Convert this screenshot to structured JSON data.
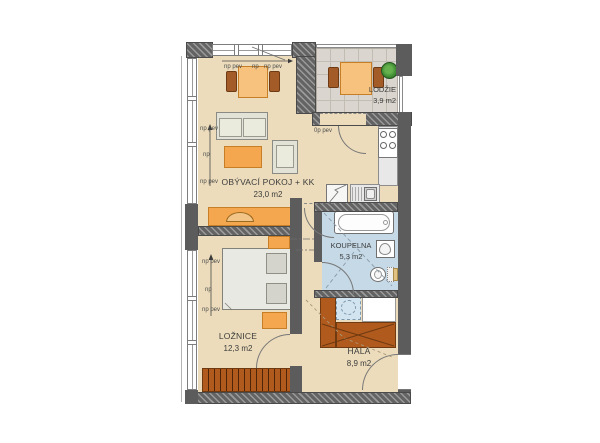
{
  "title": "apartment-floor-plan",
  "rooms": {
    "living": {
      "label": "OBÝVACÍ POKOJ + KK",
      "area": "23,0 m2"
    },
    "loggia": {
      "label": "LODŽIE",
      "area": "3,9 m2"
    },
    "bathroom": {
      "label": "KOUPELNA",
      "area": "5,3 m2"
    },
    "bedroom": {
      "label": "LOŽNICE",
      "area": "12,3 m2"
    },
    "hall": {
      "label": "HALA",
      "area": "8,9 m2"
    }
  },
  "annotations": {
    "np_pev": "np pev",
    "np": "np",
    "op_pev": "0p pev"
  },
  "fixtures": [
    "dining-table",
    "sofa",
    "coffee-table",
    "armchair",
    "tv-cabinet",
    "stove",
    "sink",
    "tall-cabinet",
    "bathtub",
    "washbasin",
    "toilet",
    "bed",
    "nightstand",
    "wardrobe",
    "hall-wardrobe",
    "washing-machine",
    "loggia-table",
    "plant"
  ],
  "colors": {
    "floor": "#ecdcbb",
    "tile": "#dad5ce",
    "bath_floor": "#c5d9e7",
    "wash_machine": "#d2e4ef",
    "furniture_orange": "#f4a74e",
    "furniture_orange_border": "#c77f27",
    "chair_brown": "#a35c28",
    "wardrobe_brown": "#b15a1d",
    "wardrobe_border": "#6f3a10",
    "wall": "#5c5c5c",
    "plant_green": "#3f8c33",
    "bed_gray": "#e9e9e3",
    "sofa_gray": "#e2e2d6",
    "counter_gray": "#e8e8e8",
    "text": "#3c3c3c"
  }
}
